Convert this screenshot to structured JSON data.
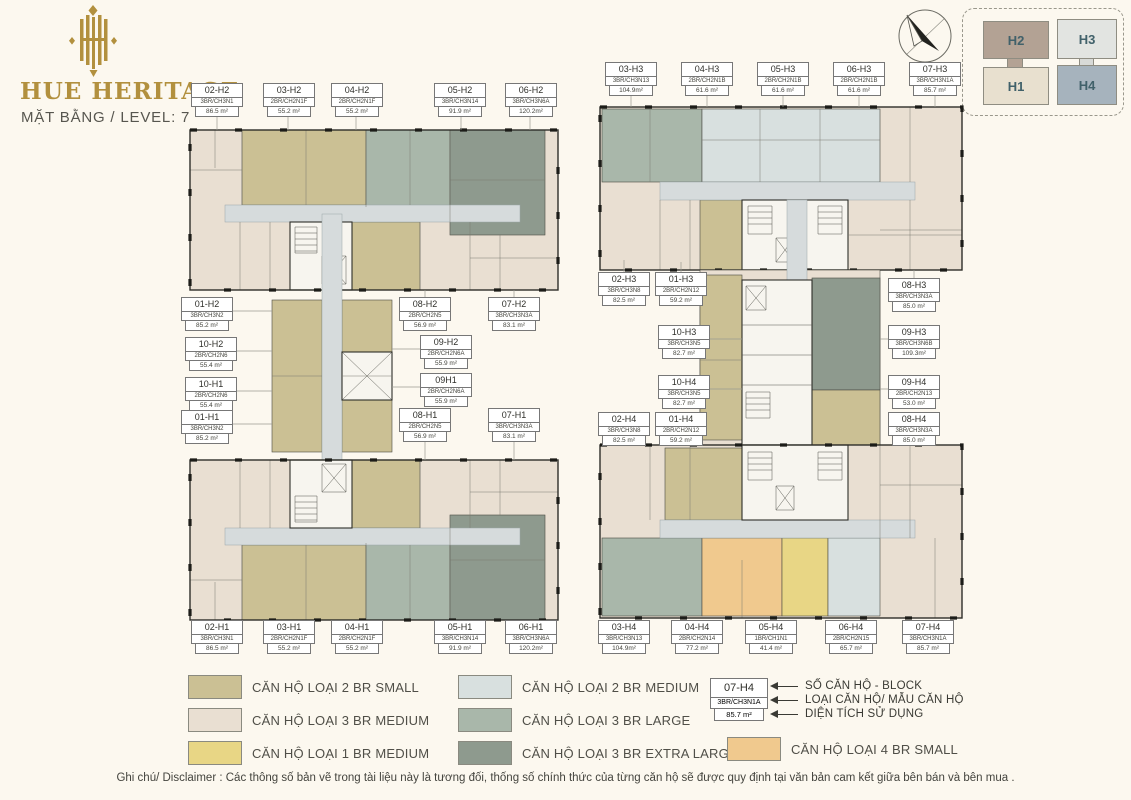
{
  "header": {
    "brand": "HUE HERITAGE",
    "subtitle": "MẶT BẰNG / LEVEL: 7"
  },
  "colors": {
    "brand_gold": "#b2903e",
    "c2s": "#cbc094",
    "c3m": "#e9dfd2",
    "c1m": "#e8d685",
    "c2m": "#d8e0df",
    "c3l": "#a9b7aa",
    "c3xl": "#8e9a8e",
    "c4s": "#f0c98e",
    "ccorr": "#d6dbdc"
  },
  "key_plan": {
    "towers": [
      {
        "label": "H2"
      },
      {
        "label": "H3"
      },
      {
        "label": "H1"
      },
      {
        "label": "H4"
      }
    ]
  },
  "blocks": {
    "left": {
      "top": [
        {
          "id": "02-H2",
          "code": "3BR/CH3N1",
          "area": "86.5 m²"
        },
        {
          "id": "03-H2",
          "code": "2BR/CH2N1F",
          "area": "55.2 m²"
        },
        {
          "id": "04-H2",
          "code": "2BR/CH2N1F",
          "area": "55.2 m²"
        },
        {
          "id": "05-H2",
          "code": "3BR/CH3N14",
          "area": "91.9 m²"
        },
        {
          "id": "06-H2",
          "code": "3BR/CH3N6A",
          "area": "120.2m²"
        }
      ],
      "side_left": [
        {
          "id": "01-H2",
          "code": "3BR/CH3N2",
          "area": "85.2 m²"
        },
        {
          "id": "10-H2",
          "code": "2BR/CH2N6",
          "area": "55.4 m²"
        },
        {
          "id": "10-H1",
          "code": "2BR/CH2N6",
          "area": "55.4 m²"
        },
        {
          "id": "01-H1",
          "code": "3BR/CH3N2",
          "area": "85.2 m²"
        }
      ],
      "side_mid": [
        {
          "id": "08-H2",
          "code": "2BR/CH2N5",
          "area": "56.9 m²"
        },
        {
          "id": "09-H2",
          "code": "2BR/CH2N6A",
          "area": "55.9 m²"
        },
        {
          "id": "09H1",
          "code": "2BR/CH2N6A",
          "area": "55.9 m²"
        },
        {
          "id": "08-H1",
          "code": "2BR/CH2N5",
          "area": "56.9 m²"
        }
      ],
      "side_right": [
        {
          "id": "07-H2",
          "code": "3BR/CH3N3A",
          "area": "83.1 m²"
        },
        {
          "id": "07-H1",
          "code": "3BR/CH3N3A",
          "area": "83.1 m²"
        }
      ],
      "bottom": [
        {
          "id": "02-H1",
          "code": "3BR/CH3N1",
          "area": "86.5 m²"
        },
        {
          "id": "03-H1",
          "code": "2BR/CH2N1F",
          "area": "55.2 m²"
        },
        {
          "id": "04-H1",
          "code": "2BR/CH2N1F",
          "area": "55.2 m²"
        },
        {
          "id": "05-H1",
          "code": "3BR/CH3N14",
          "area": "91.9 m²"
        },
        {
          "id": "06-H1",
          "code": "3BR/CH3N6A",
          "area": "120.2m²"
        }
      ]
    },
    "right": {
      "top": [
        {
          "id": "03-H3",
          "code": "3BR/CH3N13",
          "area": "104.9m²"
        },
        {
          "id": "04-H3",
          "code": "2BR/CH2N1B",
          "area": "61.6 m²"
        },
        {
          "id": "05-H3",
          "code": "2BR/CH2N1B",
          "area": "61.6 m²"
        },
        {
          "id": "06-H3",
          "code": "2BR/CH2N1B",
          "area": "61.6 m²"
        },
        {
          "id": "07-H3",
          "code": "3BR/CH3N1A",
          "area": "85.7 m²"
        }
      ],
      "side_left": [
        {
          "id": "02-H3",
          "code": "3BR/CH3N8",
          "area": "82.5 m²"
        },
        {
          "id": "01-H3",
          "code": "2BR/CH2N12",
          "area": "59.2 m²"
        },
        {
          "id": "10-H3",
          "code": "3BR/CH3N5",
          "area": "82.7 m²"
        },
        {
          "id": "10-H4",
          "code": "3BR/CH3N5",
          "area": "82.7 m²"
        },
        {
          "id": "02-H4",
          "code": "3BR/CH3N8",
          "area": "82.5 m²"
        },
        {
          "id": "01-H4",
          "code": "2BR/CH2N12",
          "area": "59.2 m²"
        }
      ],
      "side_right": [
        {
          "id": "08-H3",
          "code": "3BR/CH3N3A",
          "area": "85.0 m²"
        },
        {
          "id": "09-H3",
          "code": "3BR/CH3N6B",
          "area": "109.3m²"
        },
        {
          "id": "09-H4",
          "code": "2BR/CH2N13",
          "area": "53.0 m²"
        },
        {
          "id": "08-H4",
          "code": "3BR/CH3N3A",
          "area": "85.0 m²"
        }
      ],
      "bottom": [
        {
          "id": "03-H4",
          "code": "3BR/CH3N13",
          "area": "104.9m²"
        },
        {
          "id": "04-H4",
          "code": "2BR/CH2N14",
          "area": "77.2 m²"
        },
        {
          "id": "05-H4",
          "code": "1BR/CH1N1",
          "area": "41.4 m²"
        },
        {
          "id": "06-H4",
          "code": "2BR/CH2N15",
          "area": "65.7 m²"
        },
        {
          "id": "07-H4",
          "code": "3BR/CH3N1A",
          "area": "85.7 m²"
        }
      ]
    }
  },
  "legend": {
    "col1": [
      {
        "label": "CĂN HỘ LOẠI 2 BR SMALL",
        "color": "#cbc094"
      },
      {
        "label": "CĂN HỘ LOẠI 3 BR MEDIUM",
        "color": "#e9dfd2"
      },
      {
        "label": "CĂN HỘ LOẠI 1 BR MEDIUM",
        "color": "#e8d685"
      }
    ],
    "col2": [
      {
        "label": "CĂN HỘ LOẠI 2 BR MEDIUM",
        "color": "#d8e0df"
      },
      {
        "label": "CĂN HỘ LOẠI 3 BR LARGE",
        "color": "#a9b7aa"
      },
      {
        "label": "CĂN HỘ LOẠI 3 BR EXTRA LARGE",
        "color": "#8e9a8e"
      }
    ],
    "col3": [
      {
        "label": "CĂN HỘ LOẠI 4 BR SMALL",
        "color": "#f0c98e"
      }
    ]
  },
  "example": {
    "unit": {
      "id": "07-H4",
      "code": "3BR/CH3N1A",
      "area": "85.7 m²"
    },
    "arrow_labels": [
      "SỐ CĂN HỘ - BLOCK",
      "LOẠI CĂN HỘ/ MẪU CĂN HỘ",
      "DIỆN TÍCH SỬ DỤNG"
    ]
  },
  "disclaimer": "Ghi chú/ Disclaimer : Các thông số bản vẽ trong tài liệu này là tương đối, thống số chính thức của từng căn hộ sẽ được quy định tại văn bản cam kết giữa bên bán và bên mua ."
}
